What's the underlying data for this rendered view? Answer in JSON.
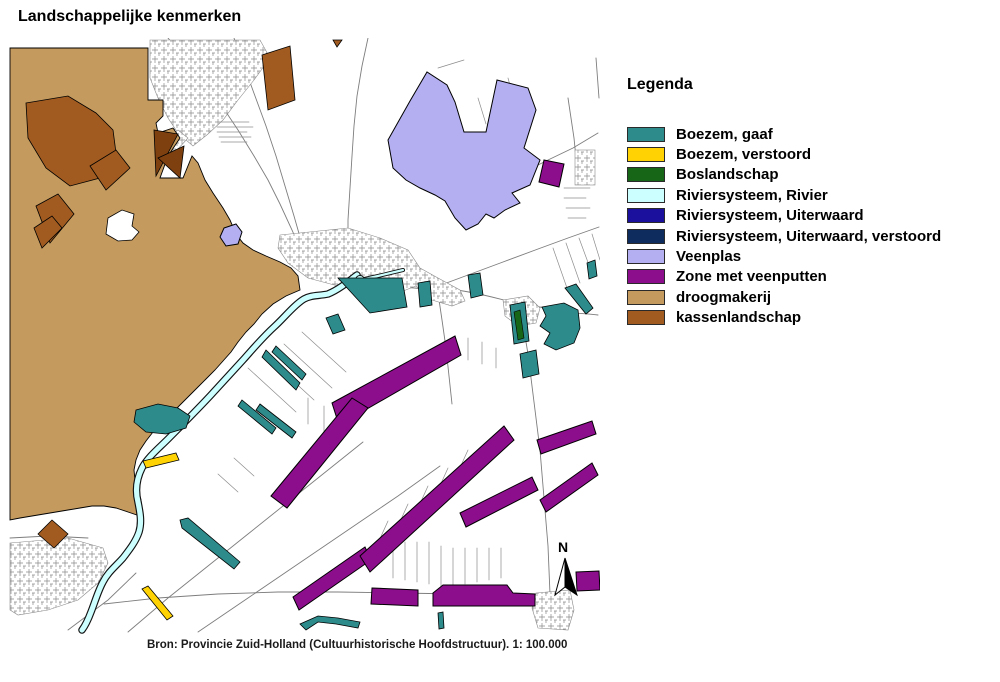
{
  "title": "Landschappelijke kenmerken",
  "caption": "Bron: Provincie Zuid-Holland (Cultuurhistorische Hoofdstructuur). 1: 100.000",
  "legend": {
    "title": "Legenda",
    "items": [
      {
        "label": "Boezem, gaaf",
        "color": "#2E8B8B"
      },
      {
        "label": "Boezem, verstoord",
        "color": "#FFD303"
      },
      {
        "label": "Boslandschap",
        "color": "#176617"
      },
      {
        "label": "Riviersysteem, Rivier",
        "color": "#CCFFFF"
      },
      {
        "label": "Riviersysteem, Uiterwaard",
        "color": "#1B0F9E"
      },
      {
        "label": "Riviersysteem, Uiterwaard, verstoord",
        "color": "#0E2C5E"
      },
      {
        "label": "Veenplas",
        "color": "#B4AFF0"
      },
      {
        "label": "Zone met veenputten",
        "color": "#8C0E8C"
      },
      {
        "label": "droogmakerij",
        "color": "#C49A5E"
      },
      {
        "label": "kassenlandschap",
        "color": "#A15B20"
      }
    ]
  },
  "map": {
    "north_label": "N",
    "scale_text": "1: 100.000",
    "feature_classes": [
      "droogmakerij",
      "kassenlandschap",
      "Veenplas",
      "Zone met veenputten",
      "Boezem, gaaf",
      "Boezem, verstoord",
      "Boslandschap",
      "Riviersysteem, Rivier"
    ]
  }
}
